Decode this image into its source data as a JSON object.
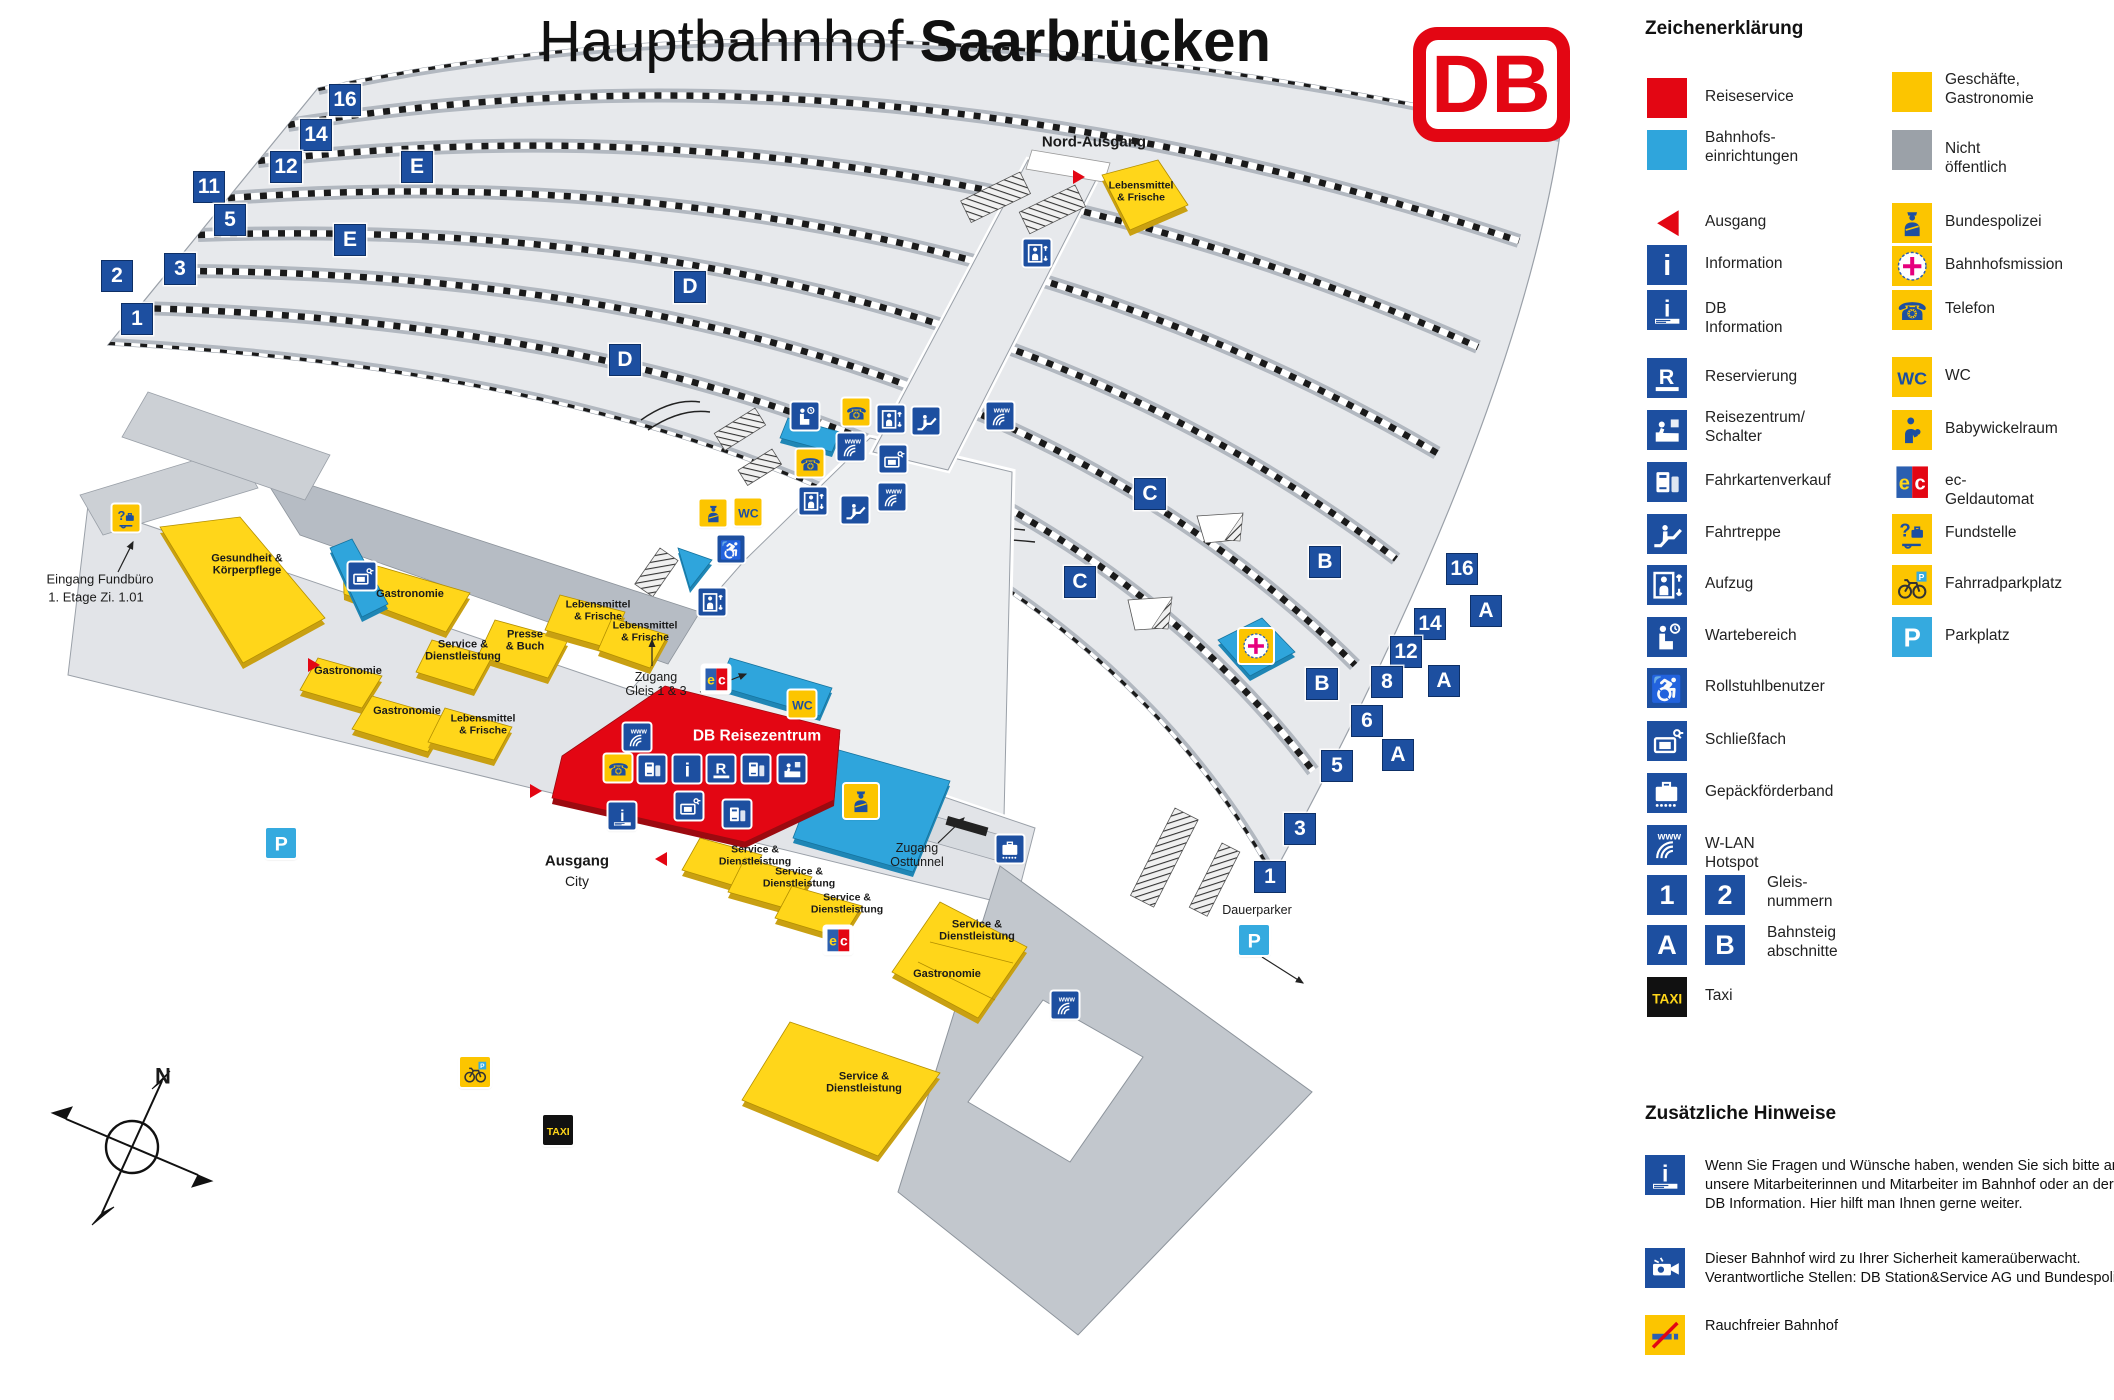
{
  "title": {
    "regular": "Hauptbahnhof ",
    "bold": "Saarbrücken"
  },
  "logo_text": "DB",
  "legend": {
    "heading": "Zeichenerklärung",
    "left_items": [
      {
        "type": "sq-reiseservice",
        "label": "Reiseservice",
        "y": 78
      },
      {
        "type": "sq-einrichtungen",
        "label": "Bahnhofs-\neinrichtungen",
        "y": 130
      },
      {
        "type": "ausgang",
        "label": "Ausgang",
        "y": 203
      },
      {
        "type": "information",
        "label": "Information",
        "y": 245
      },
      {
        "type": "db-information",
        "label": "DB Information",
        "y": 290
      },
      {
        "type": "reservierung",
        "label": "Reservierung",
        "y": 358
      },
      {
        "type": "reisezentrum",
        "label": "Reisezentrum/\nSchalter",
        "y": 410
      },
      {
        "type": "fahrkarten",
        "label": "Fahrkartenverkauf",
        "y": 462
      },
      {
        "type": "fahrtreppe",
        "label": "Fahrtreppe",
        "y": 514
      },
      {
        "type": "aufzug",
        "label": "Aufzug",
        "y": 565
      },
      {
        "type": "wartebereich",
        "label": "Wartebereich",
        "y": 617
      },
      {
        "type": "rollstuhl",
        "label": "Rollstuhlbenutzer",
        "y": 668
      },
      {
        "type": "schliessfach",
        "label": "Schließfach",
        "y": 721
      },
      {
        "type": "gepaeck",
        "label": "Gepäckförderband",
        "y": 773
      },
      {
        "type": "wlan",
        "label": "W-LAN Hotspot",
        "y": 825
      },
      {
        "type": "gleispair",
        "pair": [
          "1",
          "2"
        ],
        "label": "Gleis-\nnummern",
        "y": 875
      },
      {
        "type": "gleispair",
        "pair": [
          "A",
          "B"
        ],
        "label": "Bahnsteig\nabschnitte",
        "y": 925
      },
      {
        "type": "taxi",
        "label": "Taxi",
        "y": 977
      }
    ],
    "right_items": [
      {
        "type": "sq-geschaefte",
        "label": "Geschäfte,\nGastronomie",
        "y": 72
      },
      {
        "type": "sq-nicht",
        "label": "Nicht öffentlich",
        "y": 130
      },
      {
        "type": "bundespolizei",
        "label": "Bundespolizei",
        "y": 203
      },
      {
        "type": "bahnhofsmission",
        "label": "Bahnhofsmission",
        "y": 246
      },
      {
        "type": "telefon",
        "label": "Telefon",
        "y": 290
      },
      {
        "type": "wc",
        "label": "WC",
        "y": 357
      },
      {
        "type": "babywickel",
        "label": "Babywickelraum",
        "y": 410
      },
      {
        "type": "ec",
        "label": "ec-Geldautomat",
        "y": 462
      },
      {
        "type": "fundstelle",
        "label": "Fundstelle",
        "y": 514
      },
      {
        "type": "fahrrad",
        "label": "Fahrradparkplatz",
        "y": 565
      },
      {
        "type": "parkplatz",
        "label": "Parkplatz",
        "y": 617
      }
    ]
  },
  "notes": {
    "heading": "Zusätzliche Hinweise",
    "items": [
      {
        "type": "db-information",
        "y": 1155,
        "text": "Wenn Sie Fragen und Wünsche haben, wenden Sie sich bitte an unsere Mitarbeiterinnen und Mitarbeiter im Bahnhof oder an der DB Information. Hier hilft man Ihnen gerne weiter."
      },
      {
        "type": "camera",
        "y": 1248,
        "text": "Dieser Bahnhof wird zu Ihrer Sicherheit kameraüberwacht. Verantwortliche Stellen: DB Station&Service AG und Bundespolizei"
      },
      {
        "type": "nosmoking",
        "y": 1315,
        "text": "Rauchfreier Bahnhof"
      }
    ]
  },
  "map": {
    "badges": [
      {
        "t": "16",
        "x": 345,
        "y": 100
      },
      {
        "t": "14",
        "x": 316,
        "y": 135
      },
      {
        "t": "12",
        "x": 286,
        "y": 167
      },
      {
        "t": "E",
        "x": 417,
        "y": 167
      },
      {
        "t": "11",
        "x": 209,
        "y": 187
      },
      {
        "t": "5",
        "x": 230,
        "y": 220
      },
      {
        "t": "E",
        "x": 350,
        "y": 240
      },
      {
        "t": "3",
        "x": 180,
        "y": 269
      },
      {
        "t": "2",
        "x": 117,
        "y": 276
      },
      {
        "t": "1",
        "x": 137,
        "y": 319
      },
      {
        "t": "D",
        "x": 690,
        "y": 287
      },
      {
        "t": "D",
        "x": 625,
        "y": 360
      },
      {
        "t": "C",
        "x": 1150,
        "y": 494
      },
      {
        "t": "B",
        "x": 1325,
        "y": 562
      },
      {
        "t": "16",
        "x": 1462,
        "y": 569
      },
      {
        "t": "A",
        "x": 1486,
        "y": 611
      },
      {
        "t": "C",
        "x": 1080,
        "y": 582
      },
      {
        "t": "14",
        "x": 1430,
        "y": 624
      },
      {
        "t": "12",
        "x": 1406,
        "y": 652
      },
      {
        "t": "8",
        "x": 1387,
        "y": 682
      },
      {
        "t": "A",
        "x": 1444,
        "y": 681
      },
      {
        "t": "B",
        "x": 1322,
        "y": 684
      },
      {
        "t": "6",
        "x": 1367,
        "y": 721
      },
      {
        "t": "A",
        "x": 1398,
        "y": 755
      },
      {
        "t": "5",
        "x": 1337,
        "y": 766
      },
      {
        "t": "3",
        "x": 1300,
        "y": 829
      },
      {
        "t": "1",
        "x": 1270,
        "y": 877
      }
    ],
    "icons": [
      {
        "type": "fundstelle",
        "x": 126,
        "y": 518
      },
      {
        "type": "schliessfach",
        "x": 362,
        "y": 576
      },
      {
        "type": "wartebereich",
        "x": 805,
        "y": 416
      },
      {
        "type": "telefon",
        "x": 856,
        "y": 412
      },
      {
        "type": "wlan",
        "x": 851,
        "y": 447
      },
      {
        "type": "telefon",
        "x": 810,
        "y": 463
      },
      {
        "type": "aufzug",
        "x": 891,
        "y": 419
      },
      {
        "type": "fahrtreppe",
        "x": 926,
        "y": 421
      },
      {
        "type": "schliessfach",
        "x": 893,
        "y": 459
      },
      {
        "type": "wlan",
        "x": 892,
        "y": 497
      },
      {
        "type": "fahrtreppe",
        "x": 855,
        "y": 510
      },
      {
        "type": "aufzug",
        "x": 813,
        "y": 501
      },
      {
        "type": "bundespolizei",
        "x": 713,
        "y": 513
      },
      {
        "type": "wc",
        "x": 748,
        "y": 512
      },
      {
        "type": "rollstuhl",
        "x": 731,
        "y": 549
      },
      {
        "type": "aufzug",
        "x": 712,
        "y": 602
      },
      {
        "type": "aufzug",
        "x": 1037,
        "y": 253
      },
      {
        "type": "wlan",
        "x": 1000,
        "y": 416
      },
      {
        "type": "wlan",
        "x": 1065,
        "y": 1005
      },
      {
        "type": "wlan",
        "x": 637,
        "y": 737
      },
      {
        "type": "bahnhofsmission",
        "x": 1256,
        "y": 646,
        "s": 34
      },
      {
        "type": "gepaeck",
        "x": 1010,
        "y": 849
      },
      {
        "type": "ec",
        "x": 716,
        "y": 679
      },
      {
        "type": "wc",
        "x": 802,
        "y": 704
      },
      {
        "type": "ec",
        "x": 838,
        "y": 940
      },
      {
        "type": "bundespolizei",
        "x": 861,
        "y": 801,
        "s": 34
      },
      {
        "type": "telefon",
        "x": 618,
        "y": 768
      },
      {
        "type": "fahrkarten",
        "x": 652,
        "y": 769
      },
      {
        "type": "information",
        "x": 687,
        "y": 769
      },
      {
        "type": "reservierung",
        "x": 721,
        "y": 769
      },
      {
        "type": "fahrkarten",
        "x": 756,
        "y": 769
      },
      {
        "type": "reisezentrum",
        "x": 792,
        "y": 769
      },
      {
        "type": "db-information",
        "x": 622,
        "y": 816
      },
      {
        "type": "schliessfach",
        "x": 689,
        "y": 806
      },
      {
        "type": "fahrkarten",
        "x": 737,
        "y": 814
      },
      {
        "type": "parkplatz",
        "x": 281,
        "y": 843,
        "s": 30
      },
      {
        "type": "parkplatz",
        "x": 1254,
        "y": 940,
        "s": 30
      },
      {
        "type": "fahrrad",
        "x": 475,
        "y": 1072,
        "s": 30
      },
      {
        "type": "taxi",
        "x": 558,
        "y": 1130,
        "s": 30
      }
    ],
    "labels": [
      {
        "t": "Nord-Ausgang",
        "x": 1094,
        "y": 143,
        "s": 15,
        "b": 1
      },
      {
        "t": "Eingang Fundbüro",
        "x": 100,
        "y": 580,
        "s": 13
      },
      {
        "t": "1. Etage Zi. 1.01",
        "x": 96,
        "y": 598,
        "s": 13
      },
      {
        "t": "Zugang\nGleis 1 & 3",
        "x": 656,
        "y": 684,
        "s": 12.5
      },
      {
        "t": "Zugang\nOsttunnel",
        "x": 917,
        "y": 855,
        "s": 12.5
      },
      {
        "t": "Ausgang",
        "x": 577,
        "y": 862,
        "s": 15,
        "b": 1
      },
      {
        "t": "City",
        "x": 577,
        "y": 882,
        "s": 14
      },
      {
        "t": "Dauerparker",
        "x": 1257,
        "y": 910,
        "s": 12.5
      },
      {
        "t": "DB Reisezentrum",
        "x": 757,
        "y": 736,
        "s": 15.5,
        "b": 1,
        "c": "#ffffff"
      },
      {
        "t": "N",
        "x": 163,
        "y": 1077,
        "s": 22,
        "b": 1
      },
      {
        "t": "Gesundheit &\nKörperpflege",
        "x": 247,
        "y": 565,
        "s": 11,
        "b": 1
      },
      {
        "t": "Gastronomie",
        "x": 410,
        "y": 594,
        "s": 11,
        "b": 1
      },
      {
        "t": "Presse\n& Buch",
        "x": 525,
        "y": 641,
        "s": 11,
        "b": 1
      },
      {
        "t": "Lebensmittel\n& Frische",
        "x": 598,
        "y": 611,
        "s": 10.5,
        "b": 1
      },
      {
        "t": "Lebensmittel\n& Frische",
        "x": 645,
        "y": 632,
        "s": 10.5,
        "b": 1
      },
      {
        "t": "Service &\nDienstleistung",
        "x": 463,
        "y": 651,
        "s": 11,
        "b": 1
      },
      {
        "t": "Gastronomie",
        "x": 348,
        "y": 671,
        "s": 11,
        "b": 1
      },
      {
        "t": "Gastronomie",
        "x": 407,
        "y": 711,
        "s": 11,
        "b": 1
      },
      {
        "t": "Lebensmittel\n& Frische",
        "x": 483,
        "y": 725,
        "s": 10.5,
        "b": 1
      },
      {
        "t": "Service &\nDienstleistung",
        "x": 755,
        "y": 856,
        "s": 10.5,
        "b": 1
      },
      {
        "t": "Service &\nDienstleistung",
        "x": 799,
        "y": 878,
        "s": 10.5,
        "b": 1
      },
      {
        "t": "Service &\nDienstleistung",
        "x": 847,
        "y": 904,
        "s": 10.5,
        "b": 1
      },
      {
        "t": "Service &\nDienstleistung",
        "x": 977,
        "y": 931,
        "s": 11,
        "b": 1
      },
      {
        "t": "Gastronomie",
        "x": 947,
        "y": 974,
        "s": 11,
        "b": 1
      },
      {
        "t": "Service &\nDienstleistung",
        "x": 864,
        "y": 1083,
        "s": 11,
        "b": 1
      },
      {
        "t": "Lebensmittel\n& Frische",
        "x": 1141,
        "y": 192,
        "s": 10.5,
        "b": 1
      }
    ]
  }
}
